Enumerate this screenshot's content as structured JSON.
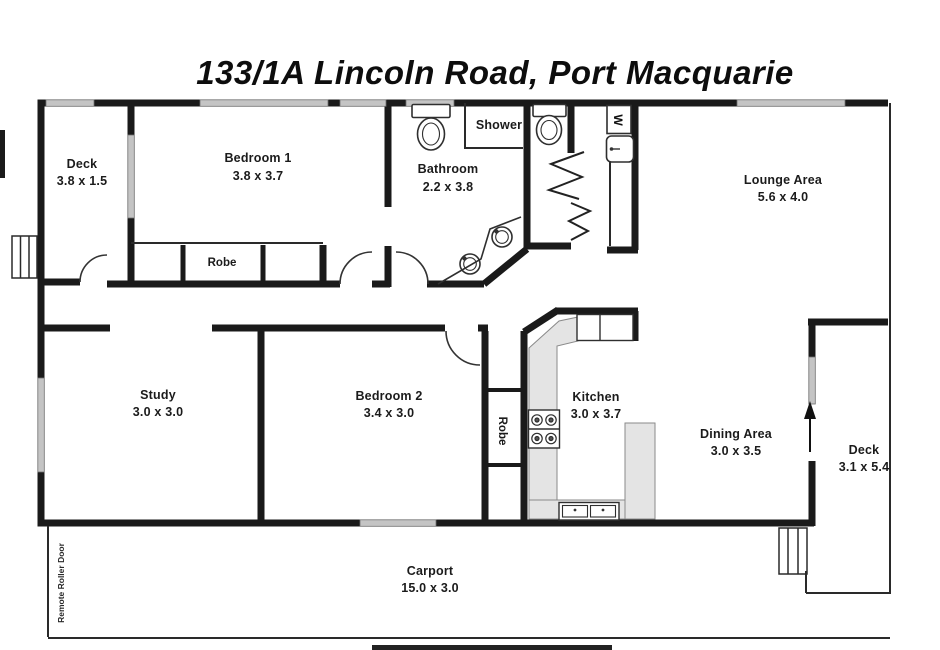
{
  "title": "133/1A Lincoln Road, Port Macquarie",
  "rooms": {
    "deck_left": {
      "name": "Deck",
      "dims": "3.8 x 1.5"
    },
    "bedroom1": {
      "name": "Bedroom 1",
      "dims": "3.8 x 3.7"
    },
    "bathroom": {
      "name": "Bathroom",
      "dims": "2.2 x 3.8"
    },
    "shower": {
      "name": "Shower"
    },
    "lounge": {
      "name": "Lounge Area",
      "dims": "5.6 x 4.0"
    },
    "robe1": {
      "name": "Robe"
    },
    "study": {
      "name": "Study",
      "dims": "3.0 x 3.0"
    },
    "bedroom2": {
      "name": "Bedroom 2",
      "dims": "3.4 x 3.0"
    },
    "robe2": {
      "name": "Robe"
    },
    "kitchen": {
      "name": "Kitchen",
      "dims": "3.0 x 3.7"
    },
    "dining": {
      "name": "Dining Area",
      "dims": "3.0 x 3.5"
    },
    "deck_right": {
      "name": "Deck",
      "dims": "3.1 x 5.4"
    },
    "carport": {
      "name": "Carport",
      "dims": "15.0 x 3.0"
    }
  },
  "labels": {
    "roller_door": "Remote Roller Door",
    "washer": "W"
  },
  "colors": {
    "wall": "#1a1a1a",
    "thin_wall": "#2a2a2a",
    "window": "#c4c4c4",
    "counter": "#e4e4e4",
    "background": "#ffffff"
  }
}
